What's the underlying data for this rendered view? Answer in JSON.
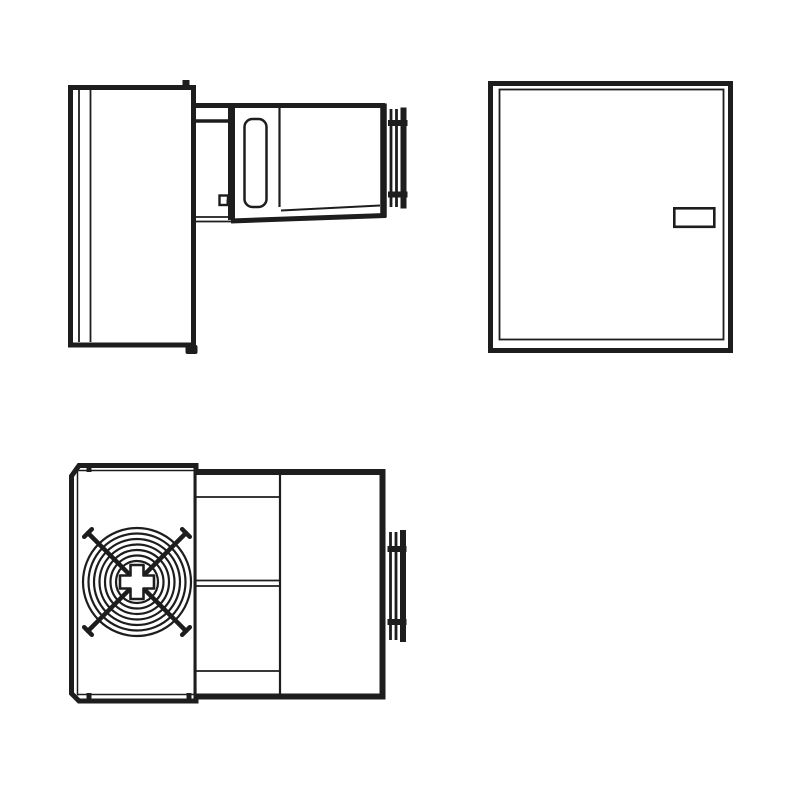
{
  "drawing": {
    "colors": {
      "line": "#1d1d1d",
      "paper": "#ffffff",
      "fill": "#ffffff"
    },
    "views": {
      "side": "monoblock-unit-side-view",
      "rear": "panel-rear-view",
      "top": "monoblock-unit-top-view-with-fan-grille"
    }
  }
}
